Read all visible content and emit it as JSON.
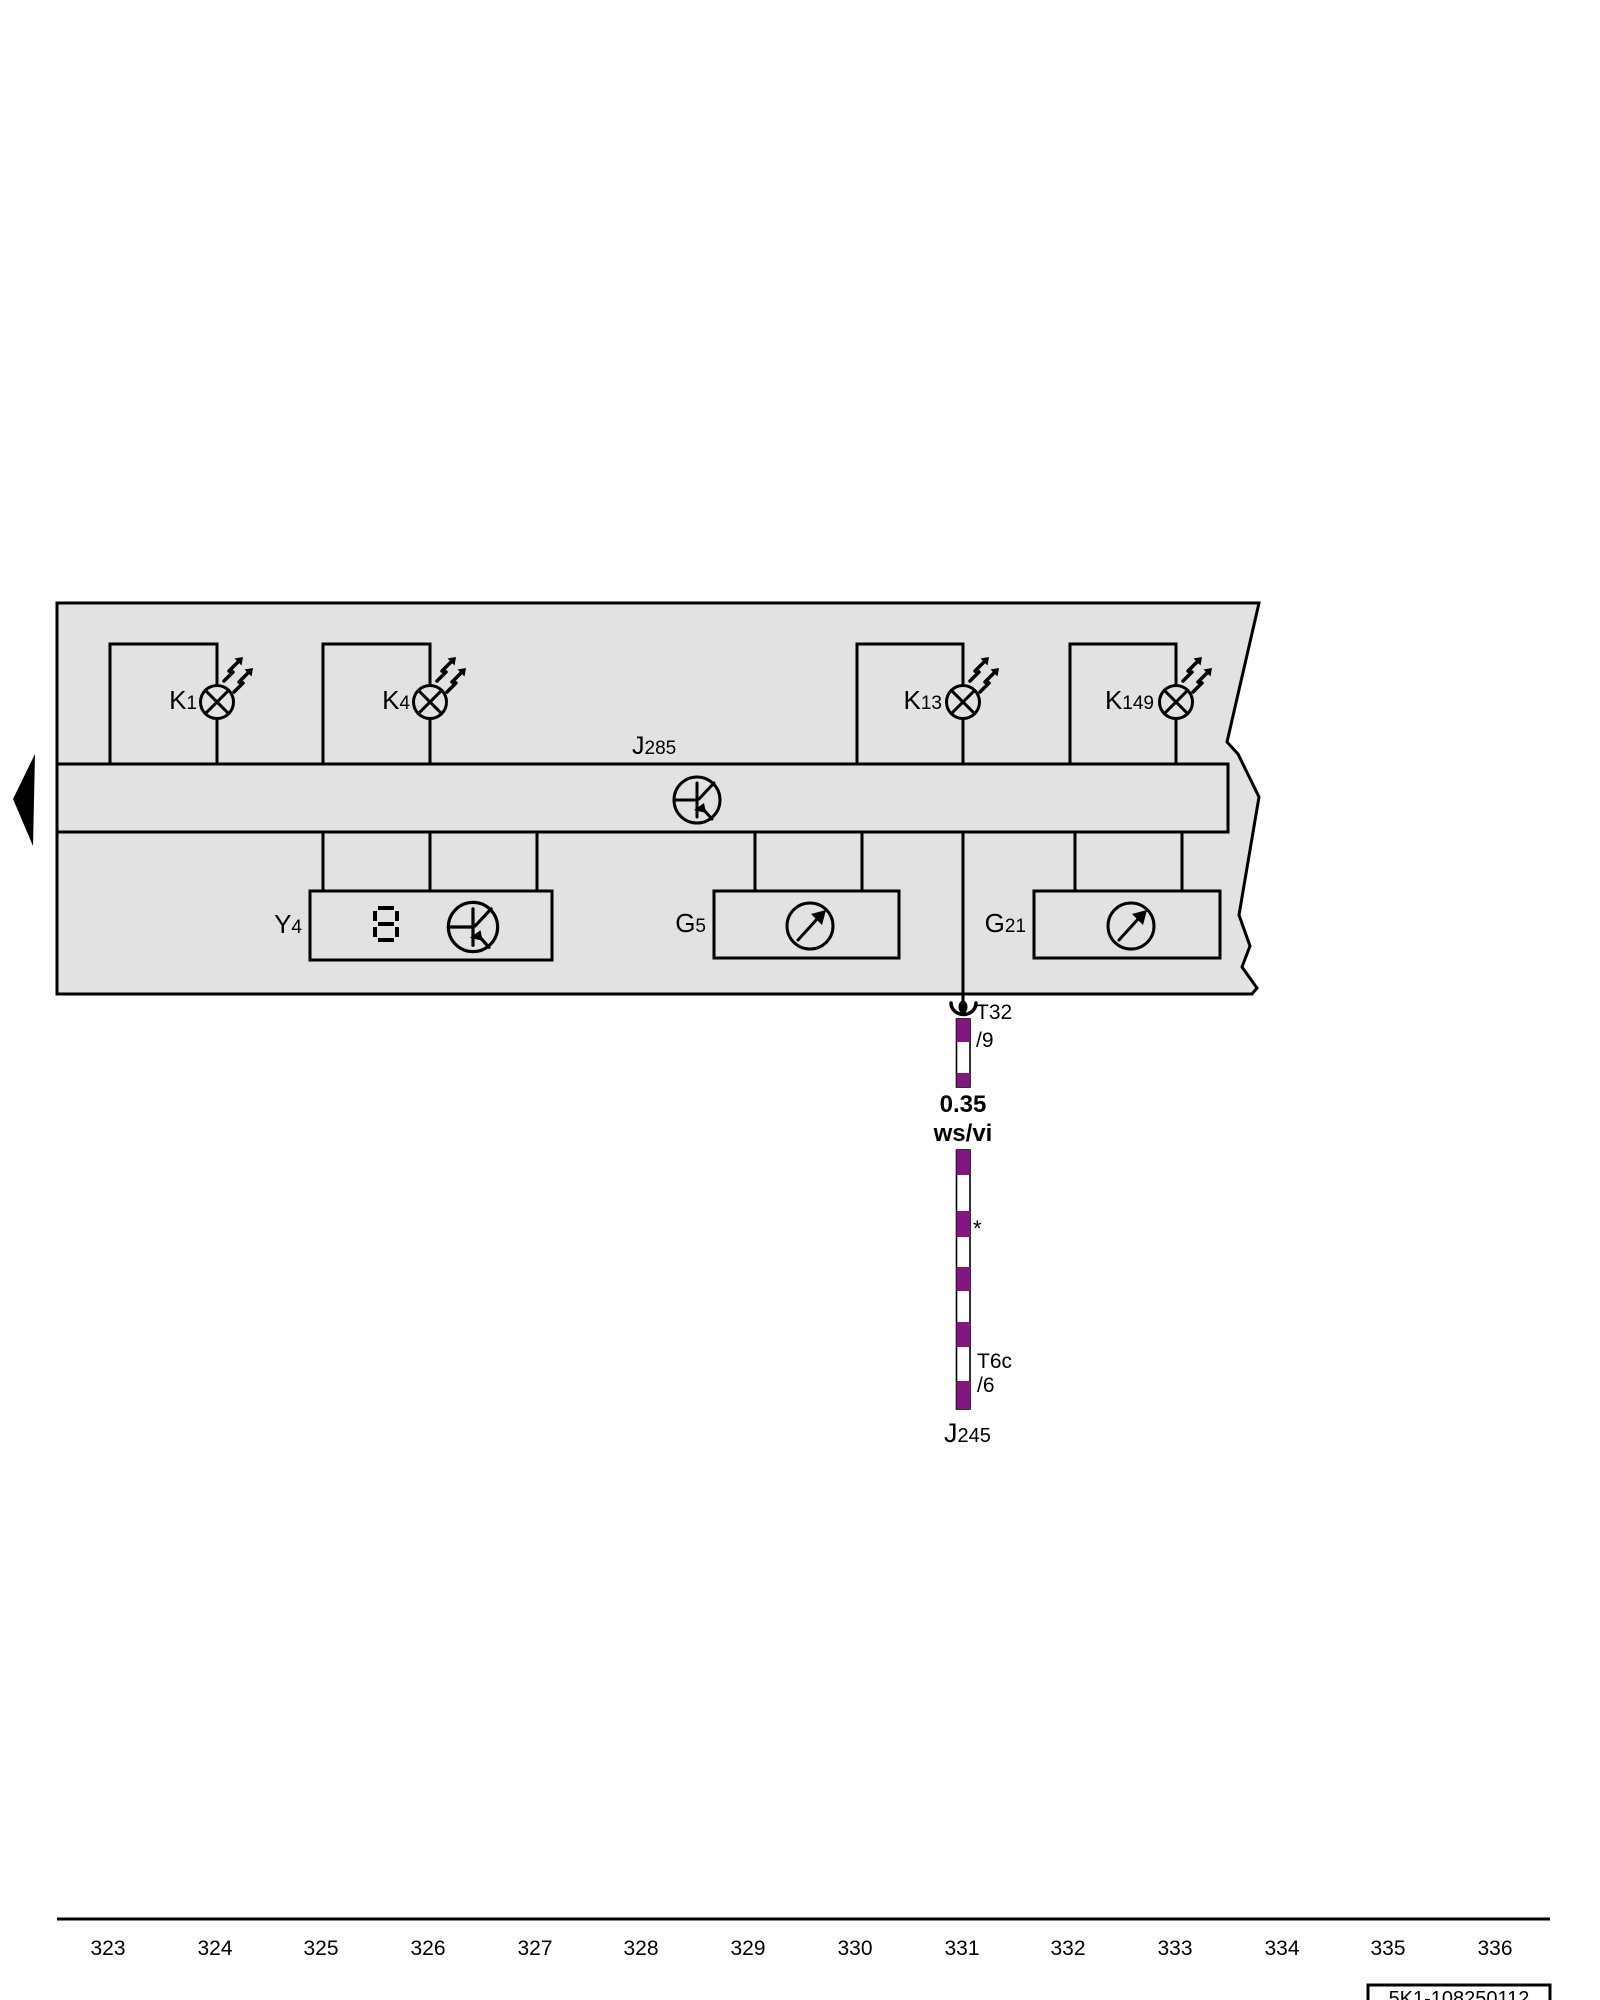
{
  "colors": {
    "panel_gray": "#e2e2e2",
    "wire_violet": "#82187f",
    "line": "#000000"
  },
  "symbols": {
    "lamp": "indicator-lamp-icon",
    "flash": "flash-arrows-icon",
    "cluster": "instrument-cluster-icon",
    "gauge": "gauge-needle-icon",
    "seven_segment": "seven-segment-display-icon",
    "connector": "connector-socket-icon",
    "continuation": "continuation-arrow-icon"
  },
  "panel": {
    "lamps": [
      {
        "letter": "K",
        "number": "1"
      },
      {
        "letter": "K",
        "number": "4"
      },
      {
        "letter": "K",
        "number": "13"
      },
      {
        "letter": "K",
        "number": "149"
      }
    ],
    "bus_label": {
      "letter": "J",
      "number": "285"
    },
    "display_label": {
      "letter": "Y",
      "number": "4"
    },
    "gauge_labels": [
      {
        "letter": "G",
        "number": "5"
      },
      {
        "letter": "G",
        "number": "21"
      }
    ]
  },
  "wire": {
    "connector_top": {
      "name": "T32",
      "pin": "/9"
    },
    "spec": {
      "cross_section": "0.35",
      "color_code": "ws/vi"
    },
    "footnote": "*",
    "connector_bottom": {
      "name": "T6c",
      "pin": "/6"
    },
    "destination": {
      "letter": "J",
      "number": "245"
    }
  },
  "scale": {
    "labels": [
      "323",
      "324",
      "325",
      "326",
      "327",
      "328",
      "329",
      "330",
      "331",
      "332",
      "333",
      "334",
      "335",
      "336"
    ]
  },
  "footer": {
    "code": "5K1-108250112"
  }
}
